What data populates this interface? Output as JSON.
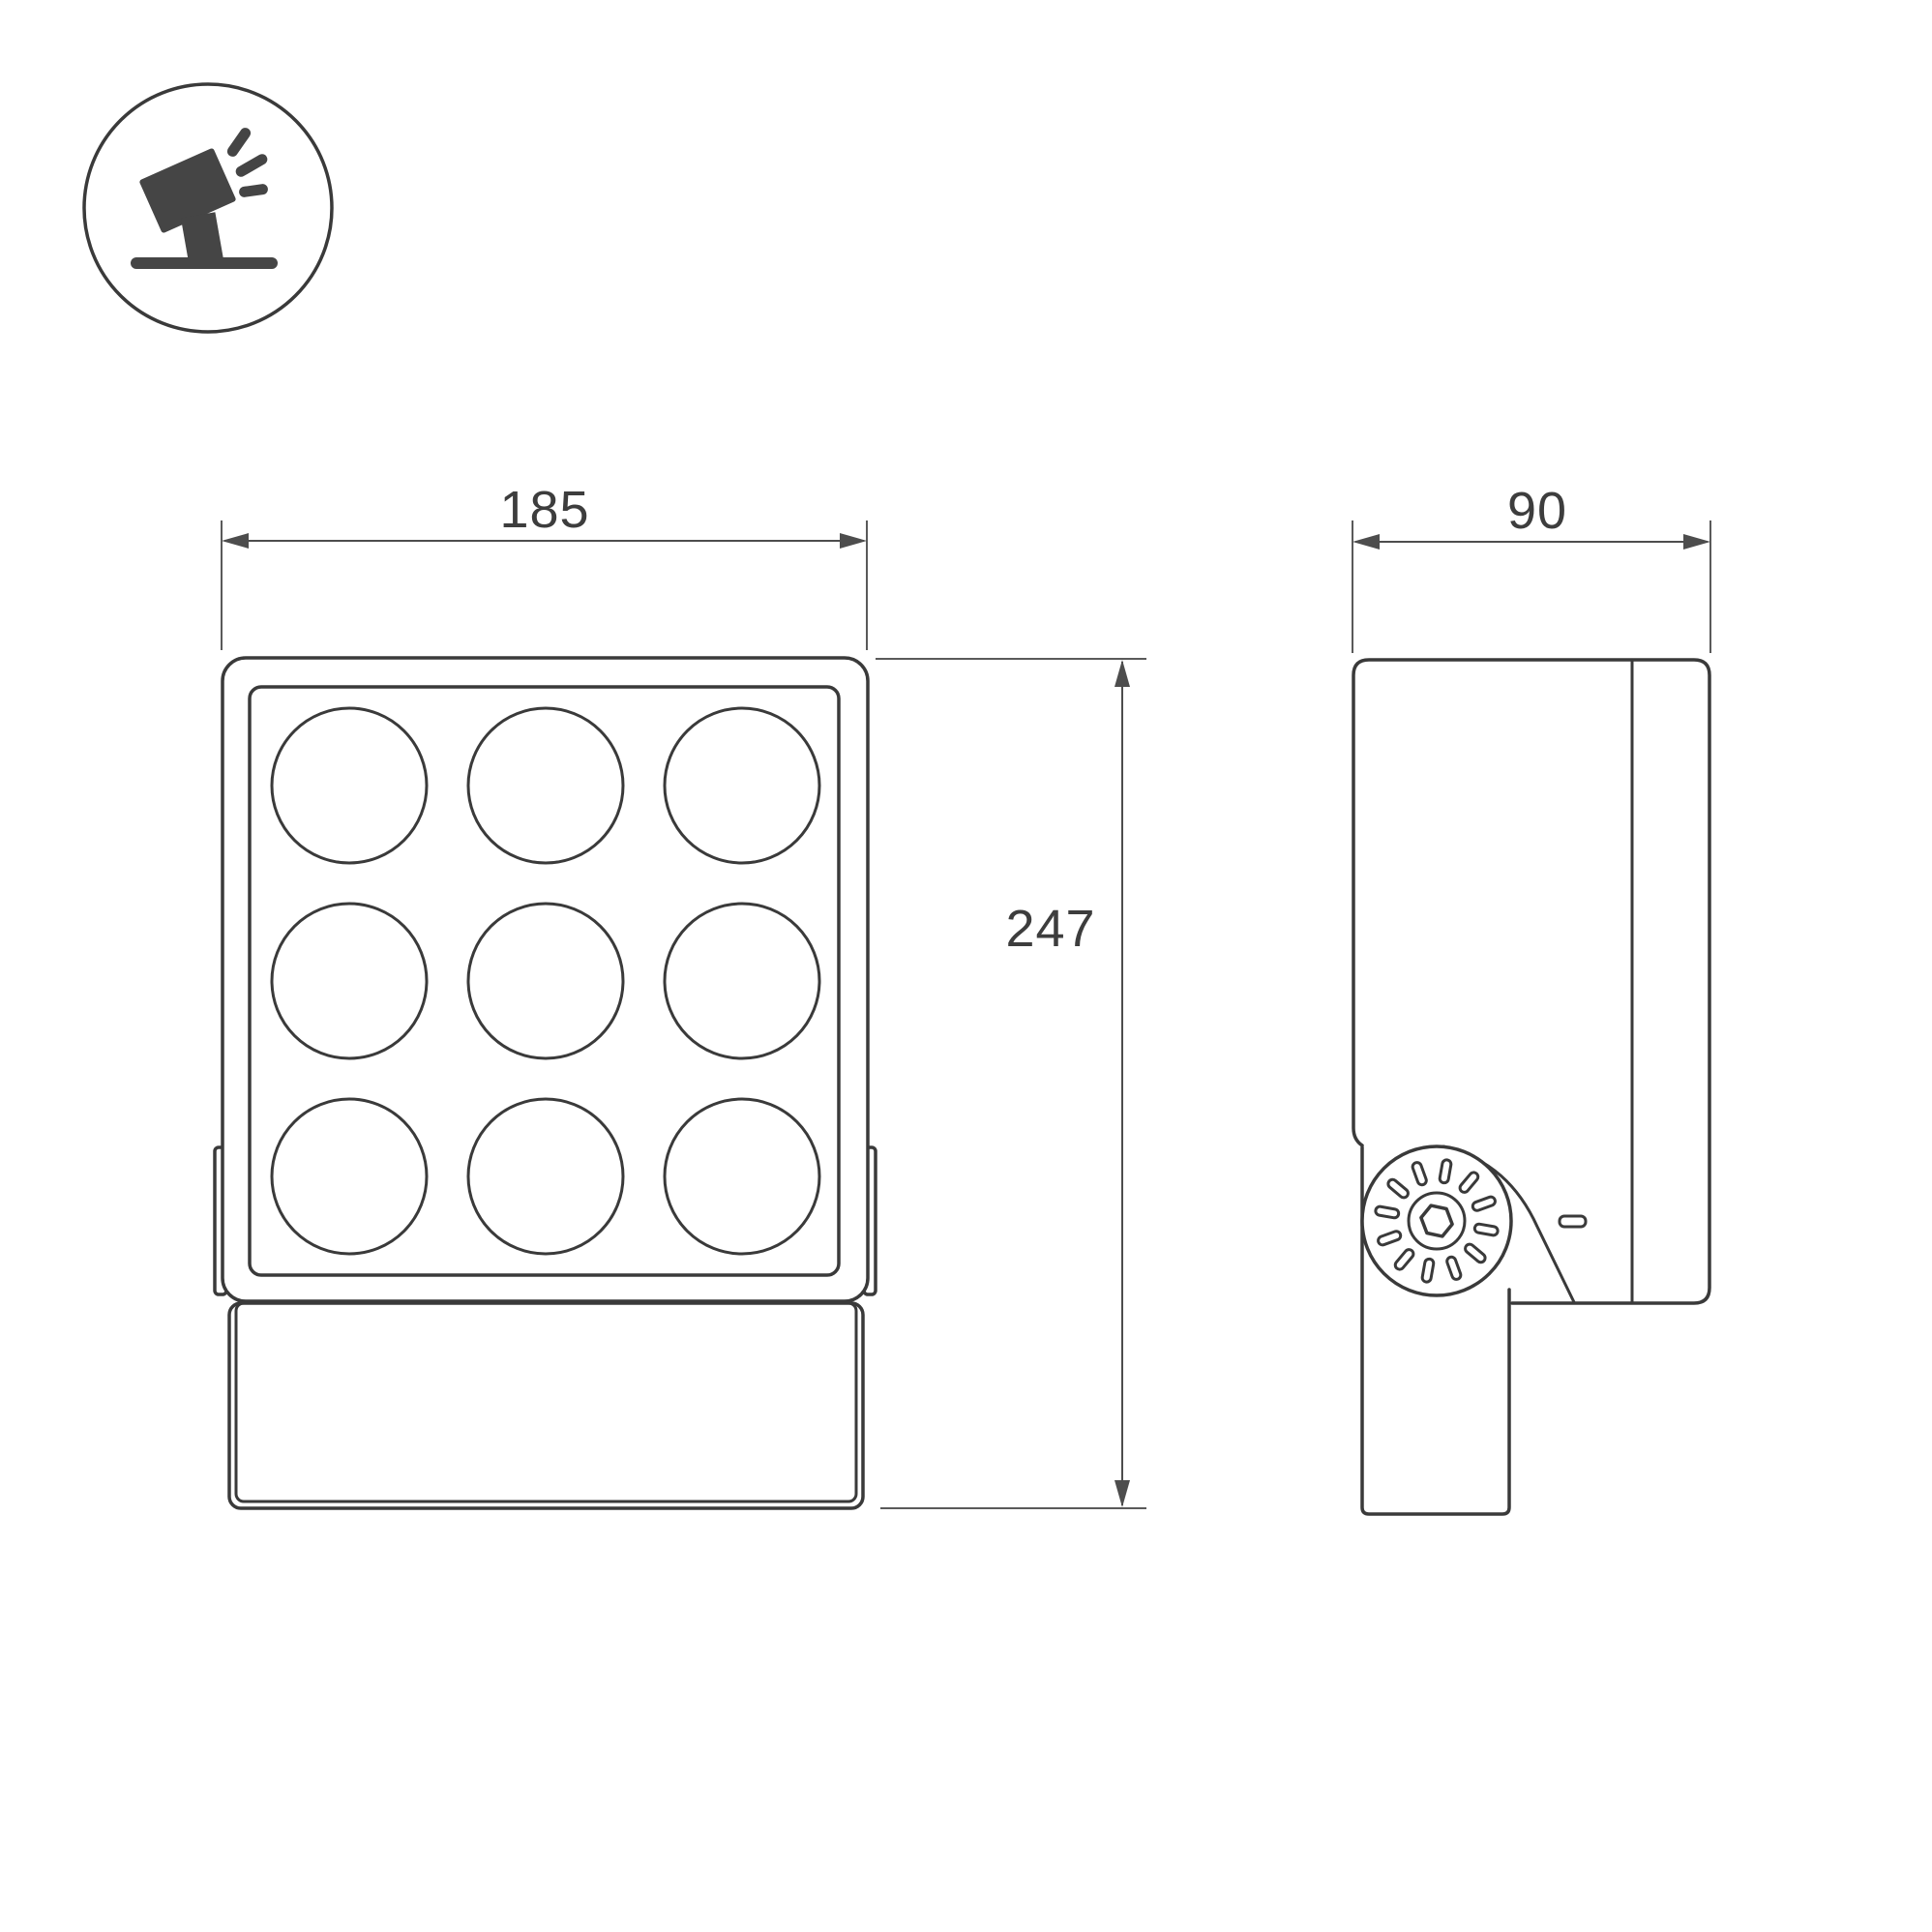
{
  "page": {
    "background_color": "#ffffff",
    "kind": "technical dimension drawing of LED floodlight"
  },
  "colors": {
    "outline": "#3a3a3a",
    "dimension_line": "#4d4d4d",
    "dimension_text": "#3d3d3d",
    "icon": "#454545"
  },
  "badge_icon": {
    "name": "tilted-floodlight-on-stand",
    "shape": "circle-outline"
  },
  "views": {
    "front": {
      "label": "front-view",
      "lens_grid": {
        "rows": 3,
        "cols": 3,
        "count": 9
      }
    },
    "side": {
      "label": "side-view",
      "ratchet_slots": 12,
      "pivot": "hex-bolt"
    }
  },
  "dimensions": {
    "width": {
      "value": "185",
      "orientation": "horizontal",
      "view": "front"
    },
    "depth": {
      "value": "90",
      "orientation": "horizontal",
      "view": "side"
    },
    "height": {
      "value": "247",
      "orientation": "vertical",
      "view": "front"
    }
  }
}
